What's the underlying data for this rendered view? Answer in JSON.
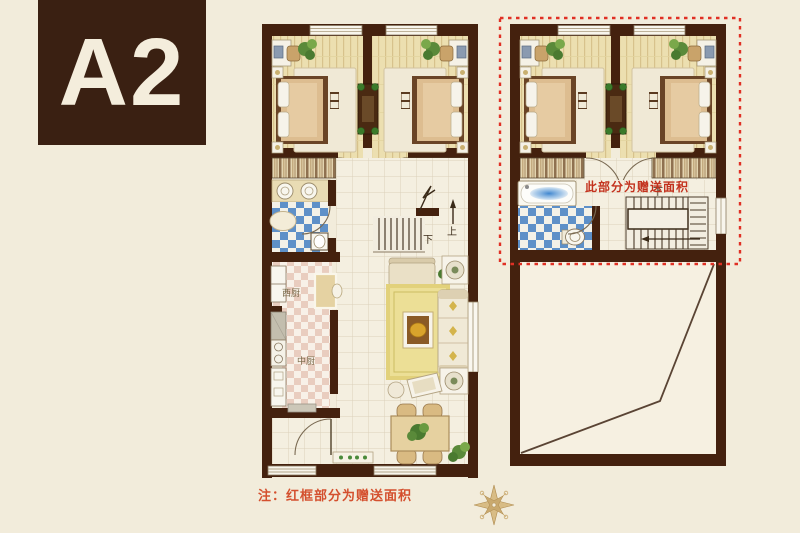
{
  "unit_label": "A2",
  "note": "注：红框部分为赠送面积",
  "plan": {
    "gift_area_label": "此部分为赠送面积",
    "kitchen": {
      "west": "西厨",
      "chinese": "中厨"
    },
    "stairs": {
      "down": "下",
      "up": "上",
      "down_right": "下"
    }
  },
  "colors": {
    "background": "#f2ecdb",
    "badge_brown": "#3a2012",
    "wall_brown": "#44210e",
    "accent_red_dashed": "#e03024",
    "note_red": "#d4502e",
    "floor_plank": "#ecdfb0",
    "tile_blue": "#5e90c8",
    "tile_pink": "#e9cdbf",
    "rug_yellow": "#ecdf96",
    "compass_tan": "#c9a96e"
  }
}
